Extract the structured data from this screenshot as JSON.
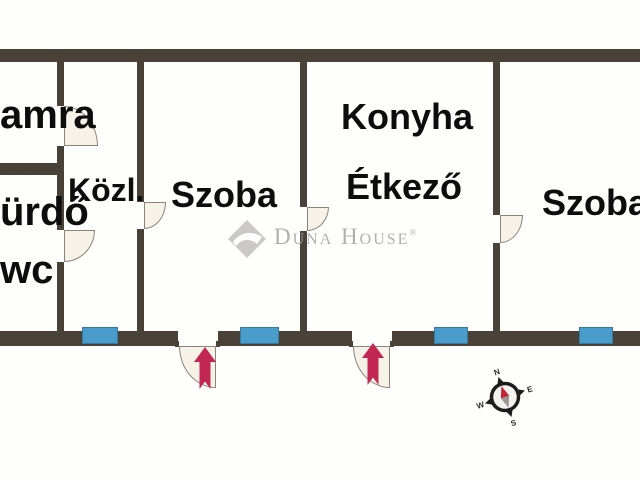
{
  "plan": {
    "title": "apartment floor plan",
    "rooms": [
      {
        "id": "kamra",
        "label": "amra"
      },
      {
        "id": "furdo",
        "label": "ürdő"
      },
      {
        "id": "wc",
        "label": "wc"
      },
      {
        "id": "kozlekedo",
        "label": "Közl."
      },
      {
        "id": "szoba-left",
        "label": "Szoba"
      },
      {
        "id": "konyha",
        "label": "Konyha"
      },
      {
        "id": "etkezo",
        "label": "Étkező"
      },
      {
        "id": "szoba-right",
        "label": "Szoba"
      }
    ],
    "window_count": 4,
    "entrance_count": 2
  },
  "watermark": {
    "brand": "Duna House",
    "registered": "®"
  },
  "compass": {
    "n": "N",
    "e": "E",
    "s": "S",
    "w": "W"
  },
  "icons": {
    "entrance_arrow": "up-arrow",
    "compass": "compass-rose",
    "logo": "duna-house-diamond"
  },
  "colors": {
    "wall": "#4a4138",
    "window": "#4a9dca",
    "door_fill": "#f7f2e7",
    "entrance_arrow": "#c22753",
    "watermark_gray": "#abaaa7",
    "label_text": "#0d0d0d",
    "background": "#fefefd"
  }
}
